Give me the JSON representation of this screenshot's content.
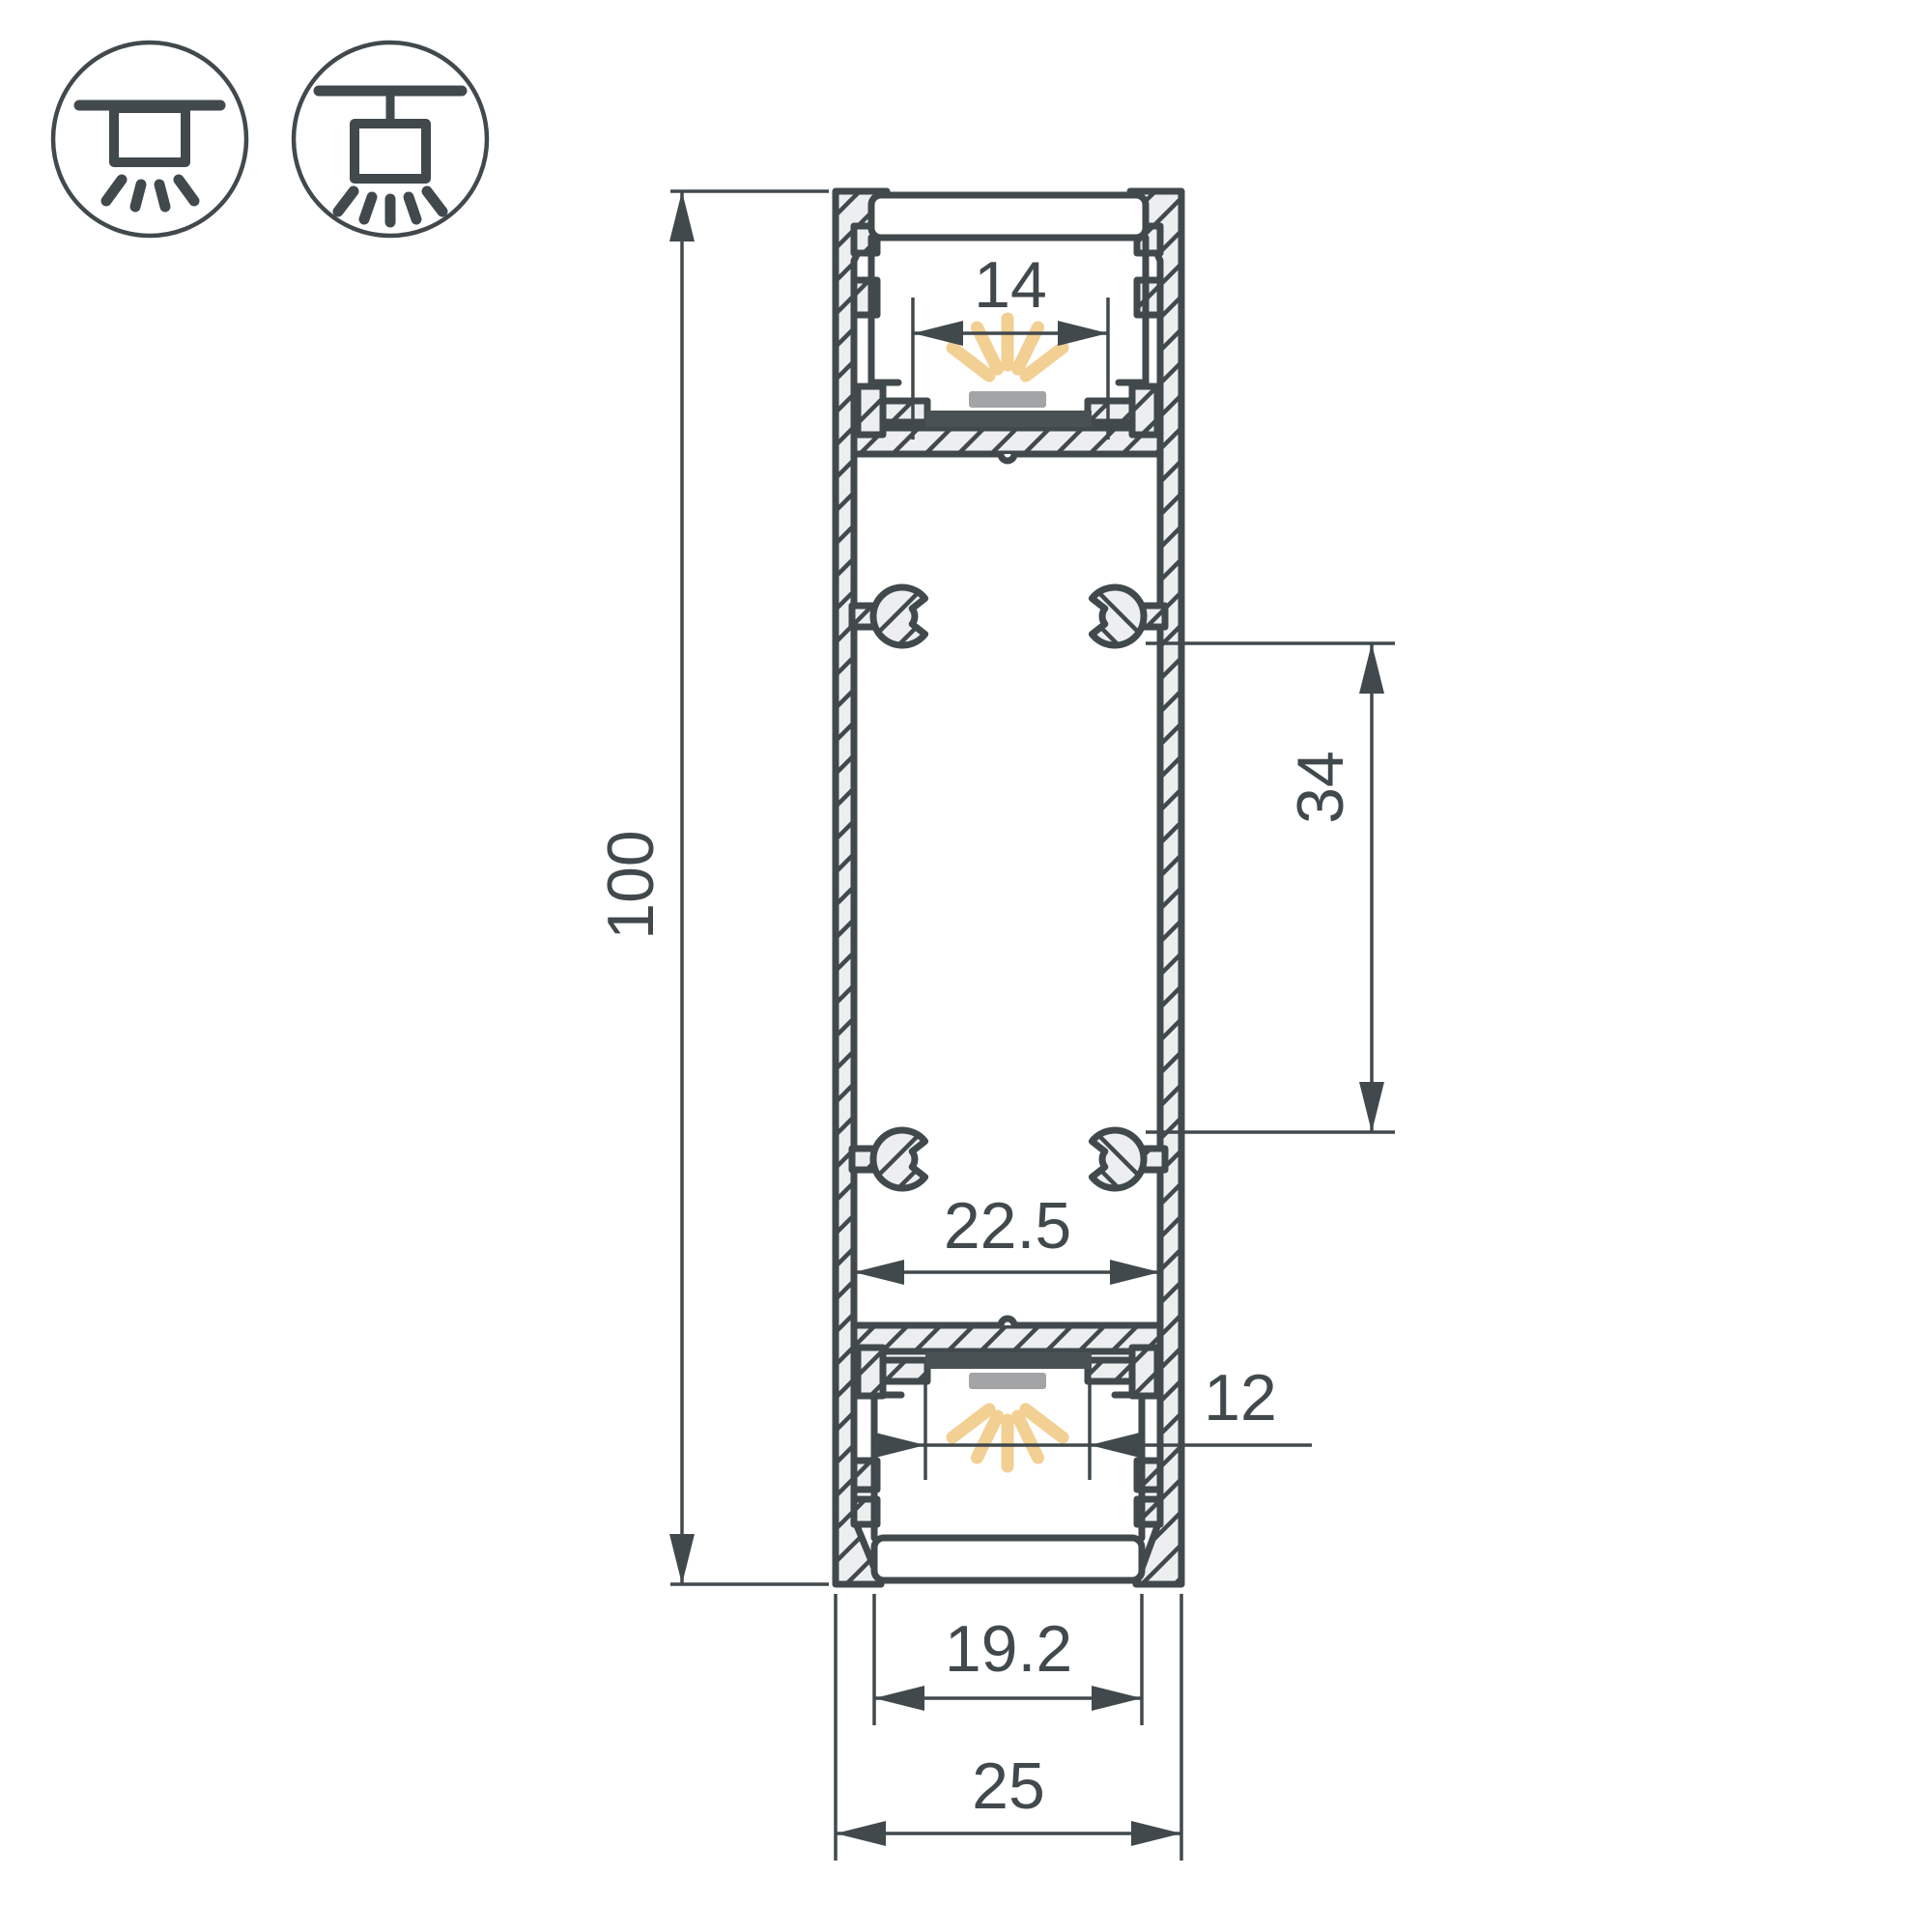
{
  "drawing": {
    "type": "led-profile-cross-section",
    "background": "#ffffff"
  },
  "colors": {
    "line": "#41494d",
    "hatch_fill": "#eceef0",
    "light_ray": "#f2cf92",
    "led_body": "#a2a4a6",
    "pcb_strip": "#4a5154"
  },
  "icons": [
    {
      "name": "surface-mount-luminaire-icon"
    },
    {
      "name": "suspended-luminaire-icon"
    }
  ],
  "dimensions": {
    "height": "100",
    "top_led_window": "14",
    "mount_boss_spacing": "34",
    "inner_width": "22.5",
    "bottom_window": "12",
    "bottom_diffuser_width": "19.2",
    "overall_width": "25"
  }
}
